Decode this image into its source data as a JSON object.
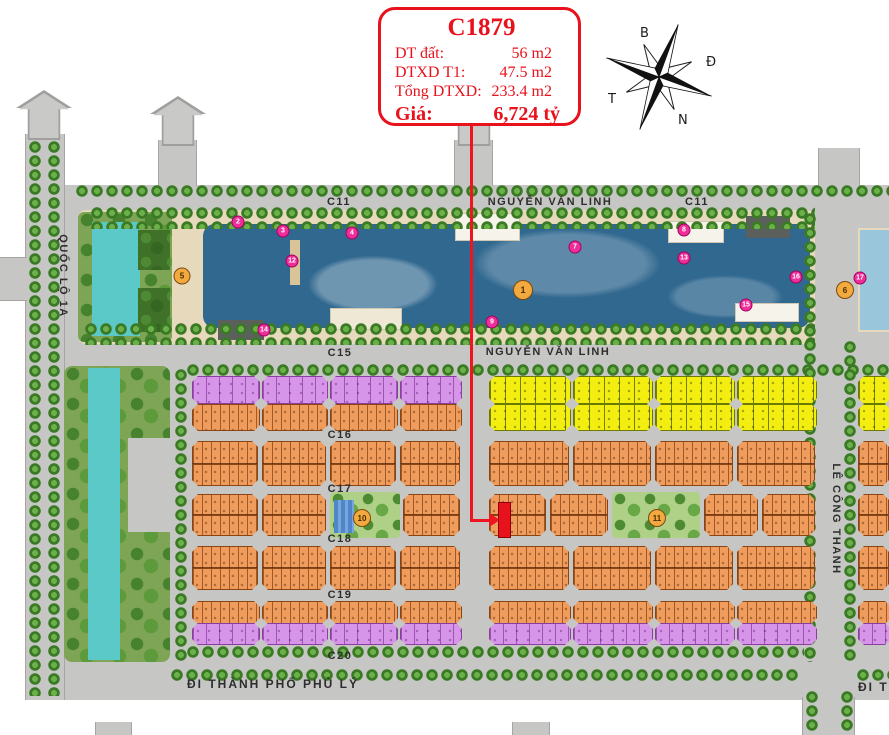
{
  "info_box": {
    "title": "C1879",
    "rows": [
      {
        "label": "DT đất:",
        "value": "56 m2"
      },
      {
        "label": "DTXD T1:",
        "value": "47.5 m2"
      },
      {
        "label": "Tổng DTXD:",
        "value": "233.4 m2"
      }
    ],
    "price_label": "Giá:",
    "price_value": "6,724 tỷ"
  },
  "compass": {
    "north_label": "B",
    "east_label": "Đ",
    "west_label": "T",
    "south_label": "N"
  },
  "roads": {
    "quoc_lo_1a": "QUỐC LỘ 1A",
    "c11_left": "C11",
    "c11_right": "C11",
    "nguyen_van_linh_top": "NGUYỄN VĂN LINH",
    "nguyen_van_linh_bottom": "NGUYỄN VĂN LINH",
    "c15": "C15",
    "c16": "C16",
    "c17": "C17",
    "c18": "C18",
    "c19": "C19",
    "c20": "C20",
    "le_cong_thanh": "LÊ CÔNG THANH",
    "di_thanh_pho_phu_ly": "ĐI THÀNH PHỐ PHỦ LÝ",
    "di_t": "ĐI T"
  },
  "badges": {
    "orange": [
      {
        "n": "1",
        "x": 523,
        "y": 290,
        "s": 18
      },
      {
        "n": "5",
        "x": 182,
        "y": 276,
        "s": 15
      },
      {
        "n": "6",
        "x": 845,
        "y": 290,
        "s": 16
      },
      {
        "n": "10",
        "x": 362,
        "y": 518,
        "s": 16
      },
      {
        "n": "11",
        "x": 657,
        "y": 518,
        "s": 16
      }
    ],
    "pink": [
      {
        "n": "2",
        "x": 238,
        "y": 222
      },
      {
        "n": "3",
        "x": 283,
        "y": 231
      },
      {
        "n": "4",
        "x": 352,
        "y": 233
      },
      {
        "n": "12",
        "x": 292,
        "y": 261
      },
      {
        "n": "14",
        "x": 264,
        "y": 330
      },
      {
        "n": "9",
        "x": 492,
        "y": 322
      },
      {
        "n": "7",
        "x": 575,
        "y": 247
      },
      {
        "n": "8",
        "x": 684,
        "y": 230
      },
      {
        "n": "13",
        "x": 684,
        "y": 258
      },
      {
        "n": "15",
        "x": 746,
        "y": 305
      },
      {
        "n": "16",
        "x": 796,
        "y": 277
      },
      {
        "n": "17",
        "x": 860,
        "y": 278
      }
    ]
  },
  "colors": {
    "accent_red": "#e8111c",
    "plot_orange": "#ef9c5c",
    "plot_purple": "#d795ea",
    "plot_yellow": "#f3ee10",
    "lake_blue": "#31688f",
    "canal_teal": "#5cc9c9",
    "road_gray": "#c6c7c5"
  }
}
